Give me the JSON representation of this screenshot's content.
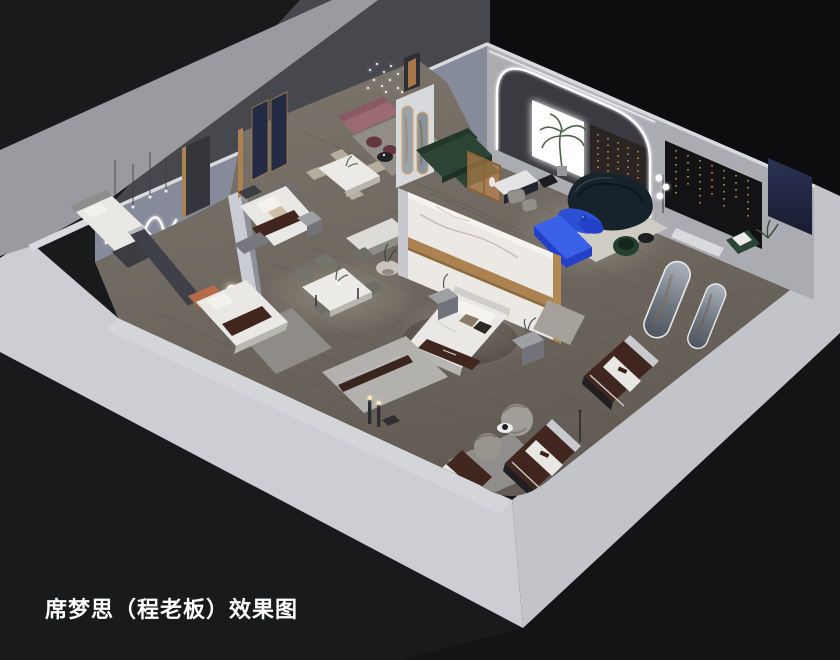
{
  "caption": {
    "text": "席梦思（程老板）效果图"
  },
  "palette": {
    "bg": "#191a1c",
    "roof": "#0d0d0f",
    "roof2": "#131416",
    "shell": "#cdced3",
    "shell-r": "#c3c4c9",
    "ext-band": "#9a9ba1",
    "ext-dark": "#47484e",
    "wall-left": "#868b9b",
    "wall-right": "#ababb2",
    "wall-top": "#d9dade",
    "gold": "#ac8250",
    "gold-light": "#d6a95e",
    "accent-blue": "#2b50d4",
    "accent-blue-dark": "#2440c8",
    "sofa-teal": "#16232b",
    "sofa-green": "#2c4434",
    "mattress-brown": "#41251f",
    "band-white": "#e9e7e3",
    "marble": "#ece9e4",
    "navy": "#262b45",
    "pink": "#9c6b72",
    "plum": "#643640",
    "amber": "#c98a4e",
    "bed-white": "#e9e8e5",
    "panel-black": "#131316",
    "glow": "#ffffff",
    "caption": "#ffffff",
    "floor-light": "#7b746b",
    "floor-dark": "#655e56"
  },
  "scene": {
    "type": "isometric-cutaway-interior-rendering",
    "objects": [
      "showroom-shell-walls",
      "wood-plank-floor",
      "wavy-neon-wall-light",
      "pendant-bulb-lights",
      "sparkle-chandelier",
      "bedroom-bed-left",
      "bedroom-bed-navy-panels",
      "bedroom-bed-terracotta",
      "glow-orb-table-lamp",
      "dining-table-six-chairs",
      "dining-table-four-chairs",
      "pink-lounge-bench",
      "plum-ottomans",
      "marble-partition-gold-inlay",
      "center-display-bed",
      "nightstands",
      "sideboard-bench",
      "round-side-table",
      "led-arch-portal",
      "backlit-white-panel",
      "palm-plant",
      "green-sectional-sofa",
      "amber-glass-partition",
      "tv-console",
      "teal-curved-sofa",
      "blue-organic-coffee-table",
      "blue-tv-bench",
      "green-velvet-chair",
      "black-accent-wall-gold-bead-lights",
      "navy-accent-panel",
      "orb-floor-lamp",
      "arched-leaning-mirrors",
      "boucle-swivel-chairs",
      "branded-mattress-displays",
      "marble-display-platform",
      "cylinder-floor-lamps",
      "area-rugs"
    ]
  }
}
